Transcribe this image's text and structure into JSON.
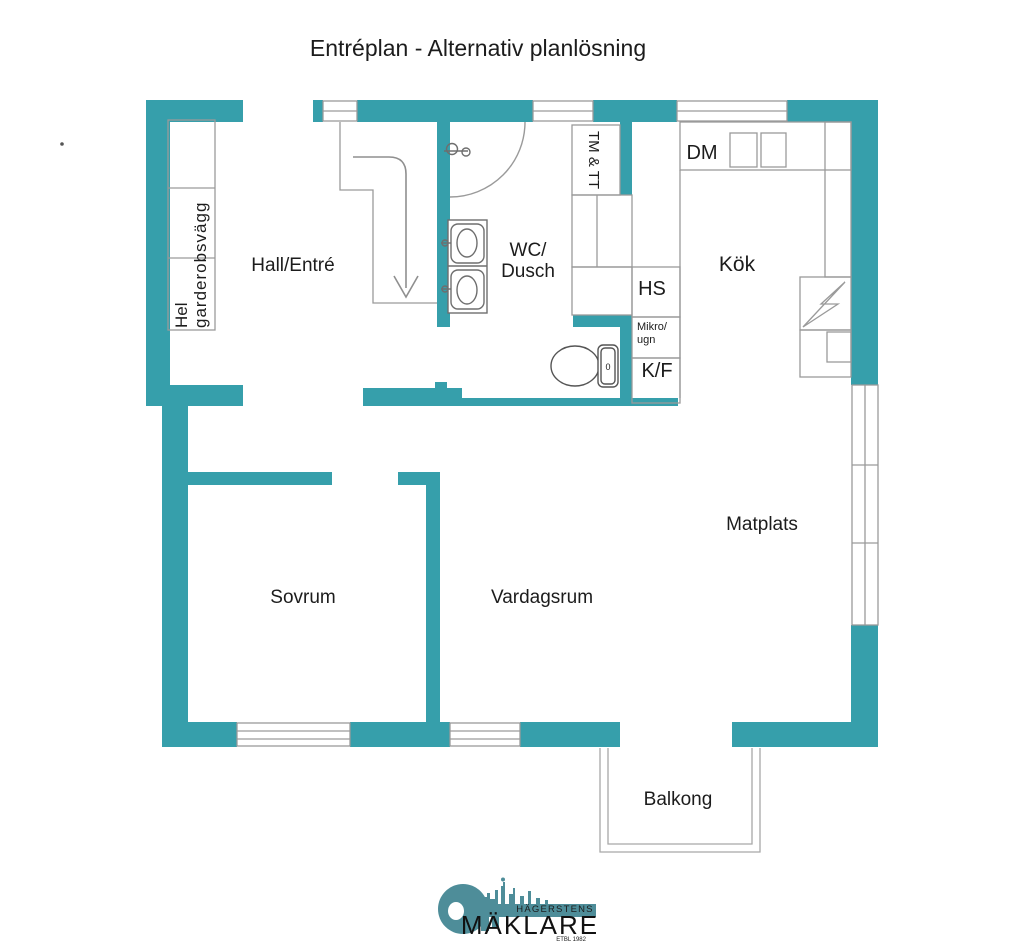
{
  "title": "Entréplan - Alternativ planlösning",
  "rooms": {
    "hall": "Hall/Entré",
    "wc": [
      "WC/",
      "Dusch"
    ],
    "kitchen": "Kök",
    "dining": "Matplats",
    "bedroom": "Sovrum",
    "living_room": "Vardagsrum",
    "balcony": "Balkong"
  },
  "annotations": {
    "wardrobe": [
      "Hel",
      "garderobsvägg"
    ],
    "washer_dryer": "TM & TT",
    "dishwasher": "DM",
    "hs": "HS",
    "micro_oven": [
      "Mikro/",
      "ugn"
    ],
    "fridge_freezer": "K/F",
    "toilet_mark": "0"
  },
  "logo": {
    "location": "HÄGERSTENS",
    "name": "MÄKLARE",
    "established": "ETBL 1982"
  },
  "colors": {
    "wall_teal": "#369fab",
    "logo_teal": "#4e8d99",
    "line_gray": "#9a9a9a",
    "fixture_gray": "#6e6e6e",
    "text_dark": "#1c1c1c"
  }
}
